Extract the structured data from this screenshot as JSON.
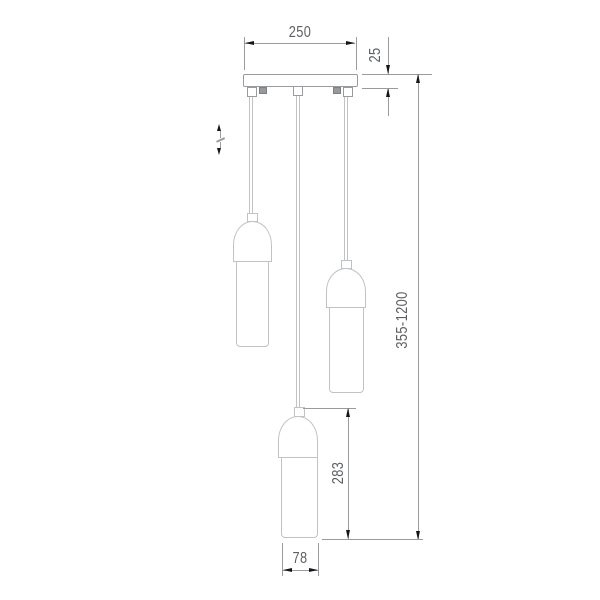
{
  "dimensions": {
    "canopy_width": "250",
    "canopy_height": "25",
    "overall_height_range": "355-1200",
    "pendant_shade_height": "283",
    "shade_width": "78"
  },
  "symbols": {
    "height_adjustment_icon": "double-vertical-arrow-adjustable"
  },
  "colors": {
    "bg": "#ffffff",
    "line": "#989ca0",
    "outline": "#c0c3c6",
    "screw": "#97999c",
    "arrow": "#161616",
    "text": "#5c6064"
  }
}
